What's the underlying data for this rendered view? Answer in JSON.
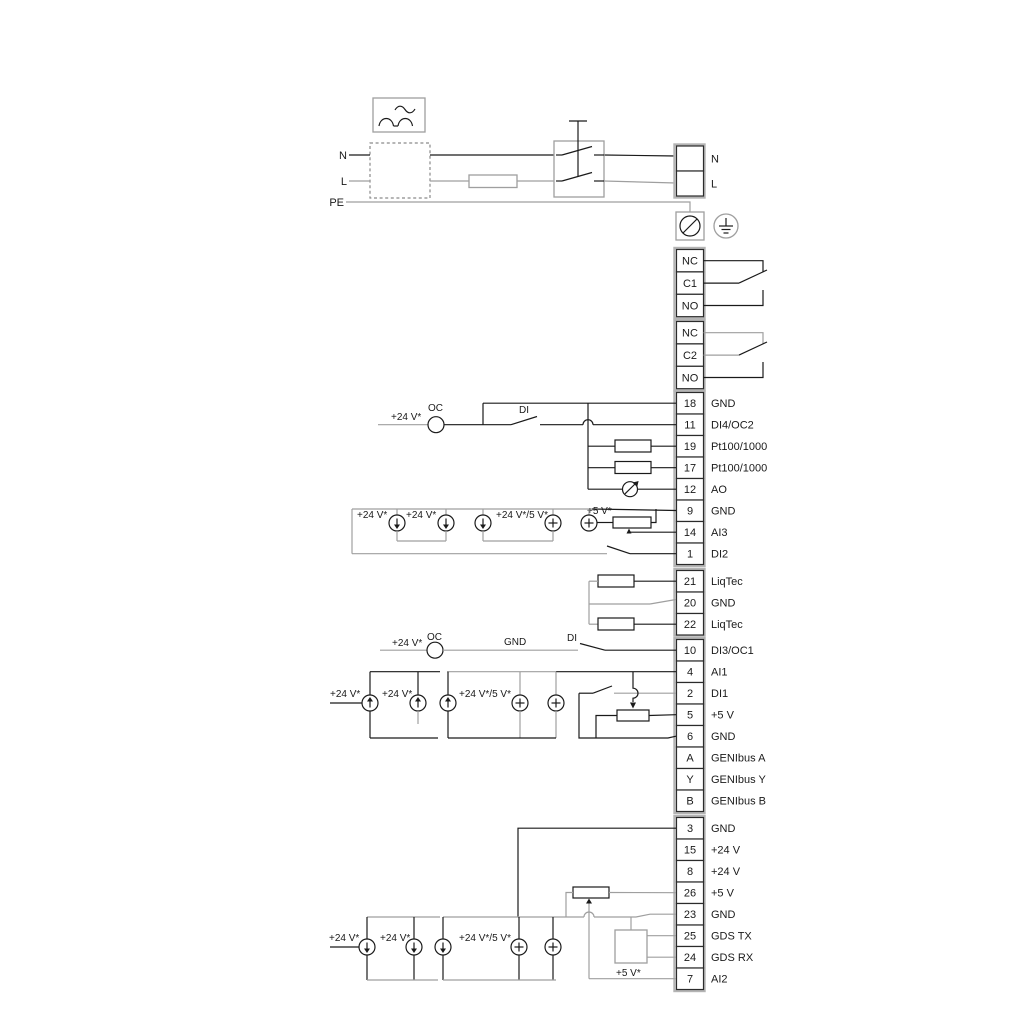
{
  "power": {
    "in_n": "N",
    "in_l": "L",
    "in_pe": "PE",
    "out_n": "N",
    "out_l": "L"
  },
  "relays": [
    {
      "rows": [
        {
          "label": "NC"
        },
        {
          "label": "C1"
        },
        {
          "label": "NO"
        }
      ]
    },
    {
      "rows": [
        {
          "label": "NC"
        },
        {
          "label": "C2"
        },
        {
          "label": "NO"
        }
      ]
    }
  ],
  "terminals": {
    "blockA": [
      {
        "num": "18",
        "label": "GND"
      },
      {
        "num": "11",
        "label": "DI4/OC2"
      },
      {
        "num": "19",
        "label": "Pt100/1000"
      },
      {
        "num": "17",
        "label": "Pt100/1000"
      },
      {
        "num": "12",
        "label": "AO"
      },
      {
        "num": "9",
        "label": "GND"
      },
      {
        "num": "14",
        "label": "AI3"
      },
      {
        "num": "1",
        "label": "DI2"
      }
    ],
    "blockB": [
      {
        "num": "21",
        "label": "LiqTec"
      },
      {
        "num": "20",
        "label": "GND"
      },
      {
        "num": "22",
        "label": "LiqTec"
      }
    ],
    "blockC": [
      {
        "num": "10",
        "label": "DI3/OC1"
      },
      {
        "num": "4",
        "label": "AI1"
      },
      {
        "num": "2",
        "label": "DI1"
      },
      {
        "num": "5",
        "label": "+5 V"
      },
      {
        "num": "6",
        "label": "GND"
      },
      {
        "num": "A",
        "label": "GENIbus A"
      },
      {
        "num": "Y",
        "label": "GENIbus Y"
      },
      {
        "num": "B",
        "label": "GENIbus B"
      }
    ],
    "blockD": [
      {
        "num": "3",
        "label": "GND"
      },
      {
        "num": "15",
        "label": "+24 V"
      },
      {
        "num": "8",
        "label": "+24 V"
      },
      {
        "num": "26",
        "label": "+5 V"
      },
      {
        "num": "23",
        "label": "GND"
      },
      {
        "num": "25",
        "label": "GDS TX"
      },
      {
        "num": "24",
        "label": "GDS RX"
      },
      {
        "num": "7",
        "label": "AI2"
      }
    ]
  },
  "labels": {
    "v24": "+24 V*",
    "v24_5": "+24 V*/5 V*",
    "v5": "+5 V*",
    "oc": "OC",
    "di": "DI",
    "gnd": "GND"
  },
  "colors": {
    "wire": "#1a1a1a",
    "wire_alt": "#9f9f9f",
    "background": "#ffffff"
  }
}
